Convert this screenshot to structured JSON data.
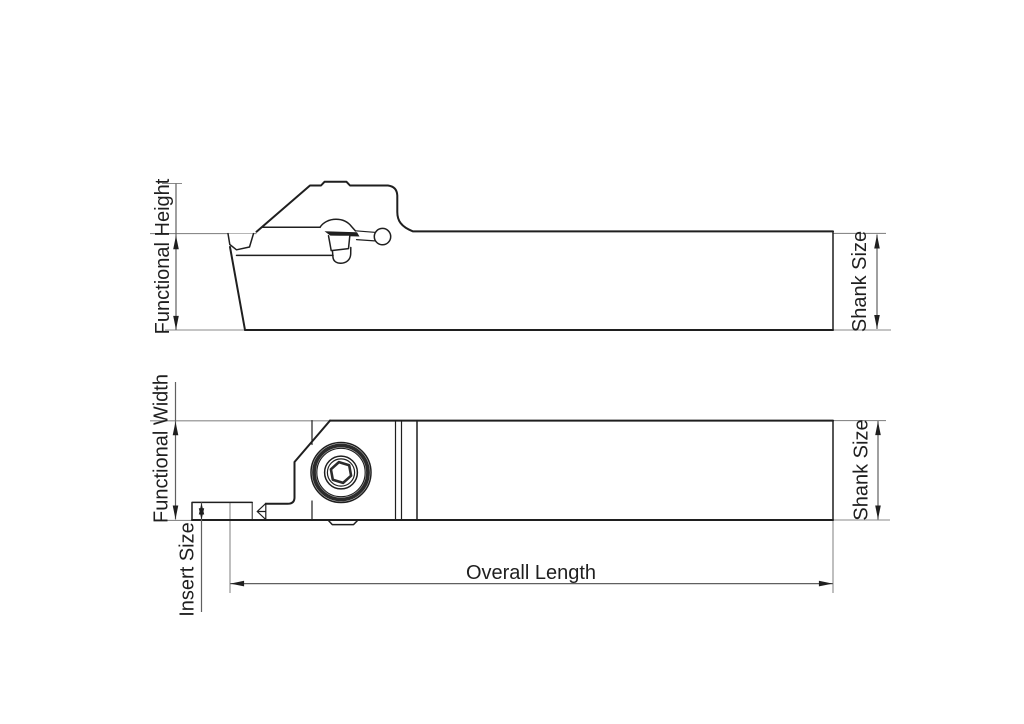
{
  "drawing_title": "Tool holder dimension drawing",
  "colors": {
    "outline": "#1f1f1f",
    "extension": "#8a8a8a",
    "dimension": "#606060",
    "ring": "#2b2b2b",
    "background": "#ffffff"
  },
  "side_view": {
    "functional_height_label": "Functional Height",
    "shank_size_label": "Shank Size"
  },
  "plan_view": {
    "functional_width_label": "Functional Width",
    "insert_size_label": "Insert Size",
    "shank_size_label": "Shank Size",
    "overall_length_label": "Overall Length"
  }
}
